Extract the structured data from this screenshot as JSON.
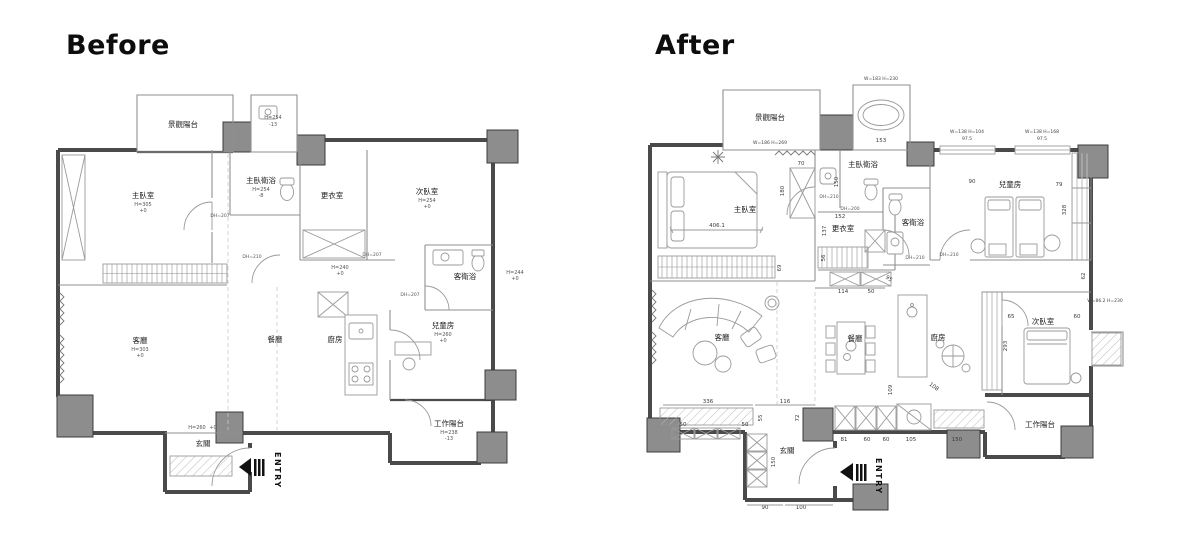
{
  "page": {
    "background": "#ffffff",
    "wall_color": "#4a4a4a",
    "column_color": "#8d8d8d",
    "line_color": "#909090"
  },
  "before": {
    "title": "Before",
    "entry_label": "ENTRY",
    "rooms": {
      "balcony": "景觀陽台",
      "master": "主臥室",
      "master_note": "H=305",
      "master_note2": "+0",
      "top_room_note": "H=254",
      "top_room_note2": "-13",
      "master_bath": "主臥衛浴",
      "master_bath_note": "H=254",
      "master_bath_note2": "-8",
      "dressing": "更衣室",
      "second": "次臥室",
      "second_note": "H=254",
      "second_note2": "+0",
      "guest_bath": "客衛浴",
      "guest_bath_note": "H=244",
      "guest_bath_note2": "+0",
      "living": "客廳",
      "living_note": "H=303",
      "living_note2": "+0",
      "dining": "餐廳",
      "kitchen": "廚房",
      "kids": "兒童房",
      "kids_note": "H=260",
      "kids_note2": "+0",
      "work_balcony": "工作陽台",
      "work_balcony_note": "H=238",
      "work_balcony_note2": "-13",
      "foyer": "玄關",
      "foyer_note": "H=260",
      "foyer_note2": "+0",
      "hall_note": "H=240",
      "hall_note2": "+0"
    },
    "doors": {
      "master_door": "DH=207",
      "hall_door": "DH=210",
      "closet_door": "DH=207",
      "kids_door": "DH=207"
    }
  },
  "after": {
    "title": "After",
    "entry_label": "ENTRY",
    "rooms": {
      "balcony": "景觀陽台",
      "master": "主臥室",
      "master_bath": "主臥衛浴",
      "dressing": "更衣室",
      "guest_bath": "客衛浴",
      "kids": "兒童房",
      "second": "次臥室",
      "living": "客廳",
      "dining": "餐廳",
      "kitchen": "廚房",
      "work_balcony": "工作陽台",
      "foyer": "玄關"
    },
    "dims": {
      "bath_window": "W=183 H=230",
      "tub_width": "153",
      "balcony_window": "W=186 H=269",
      "window1": "W=138 H=104",
      "window1_w": "97.5",
      "window2": "W=138 H=168",
      "window2_w": "97.5",
      "master_width": "406.1",
      "wardrobe_w": "70",
      "wardrobe_h": "180",
      "master_ward_h": "69",
      "bath_depth": "150",
      "master_door": "DH=210",
      "bath_door": "DH=200",
      "hall_width": "152",
      "dressing_h": "137",
      "dressing_ward": "56",
      "hall_cab1": "114",
      "hall_cab2": "50",
      "hall_diag": "95",
      "guest_door": "DH=210",
      "kids_door": "DH=210",
      "kids_w1": "90",
      "kids_w2": "79",
      "kids_ward_h": "328",
      "kids_d": "62",
      "ac_window": "W=86.2 H=230",
      "pantry_w": "65",
      "second_w": "60",
      "pantry_h": "293",
      "kitchen_diag": "108",
      "island_h": "109",
      "tv_w1": "336",
      "tv_w2": "116",
      "tv_seg1": "50",
      "tv_seg2": "50",
      "tv_h": "55",
      "cab_h": "72",
      "cab1": "81",
      "cab2": "60",
      "cab3": "60",
      "cab4": "105",
      "cab5": "150",
      "foyer_side": "150",
      "foyer_w1": "90",
      "foyer_w2": "100"
    }
  }
}
